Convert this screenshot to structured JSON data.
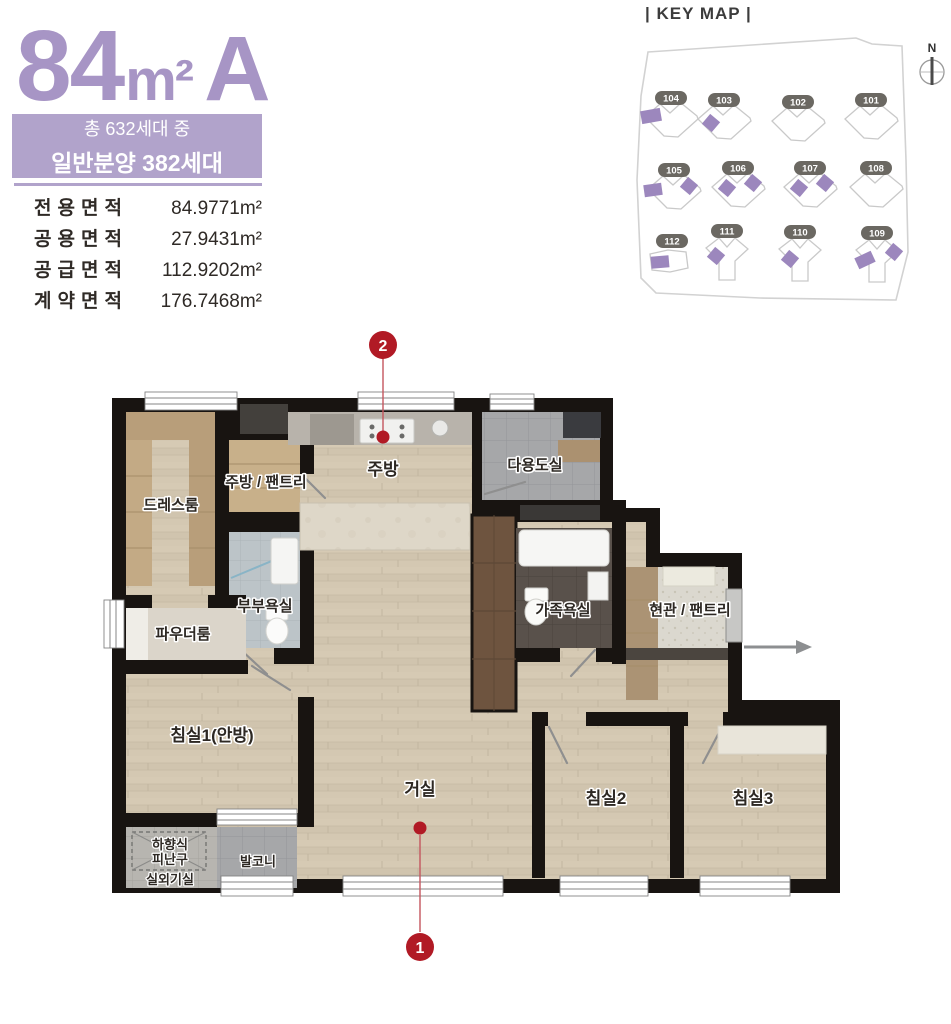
{
  "colors": {
    "accent": "#a795c5",
    "badge_bg": "#b1a3cb",
    "keymap_purple": "#9c87bd",
    "marker_red": "#b11a25",
    "wall": "#181411"
  },
  "header": {
    "title_size": "84",
    "title_unit": "m²",
    "title_type": "A",
    "badge_line1": "총 632세대 중",
    "badge_line2": "일반분양 382세대",
    "area_table": {
      "rows": [
        {
          "label": "전용면적",
          "value": "84.9771m²"
        },
        {
          "label": "공용면적",
          "value": "27.9431m²"
        },
        {
          "label": "공급면적",
          "value": "112.9202m²"
        },
        {
          "label": "계약면적",
          "value": "176.7468m²"
        }
      ]
    }
  },
  "keymap": {
    "title": "| KEY MAP |",
    "compass_north": "N",
    "buildings": [
      {
        "no": "104",
        "highlighted": true
      },
      {
        "no": "103",
        "highlighted": true
      },
      {
        "no": "102",
        "highlighted": false
      },
      {
        "no": "101",
        "highlighted": false
      },
      {
        "no": "105",
        "highlighted": true
      },
      {
        "no": "106",
        "highlighted": true
      },
      {
        "no": "107",
        "highlighted": true
      },
      {
        "no": "108",
        "highlighted": false
      },
      {
        "no": "112",
        "highlighted": true
      },
      {
        "no": "111",
        "highlighted": true
      },
      {
        "no": "110",
        "highlighted": true
      },
      {
        "no": "109",
        "highlighted": true
      }
    ]
  },
  "plan": {
    "rooms": {
      "dress_room": "드레스룸",
      "kitchen_pantry": "주방 / 팬트리",
      "kitchen": "주방",
      "utility_room": "다용도실",
      "powder_room": "파우더룸",
      "master_bathroom": "부부욕실",
      "family_bathroom": "가족욕실",
      "entrance_pantry": "현관 / 팬트리",
      "bedroom1": "침실1(안방)",
      "living_room": "거실",
      "bedroom2": "침실2",
      "bedroom3": "침실3",
      "balcony": "발코니",
      "escape_hatch_line1": "하향식",
      "escape_hatch_line2": "피난구",
      "outdoor_unit_room": "실외기실"
    },
    "markers": [
      {
        "no": "1"
      },
      {
        "no": "2"
      }
    ]
  }
}
